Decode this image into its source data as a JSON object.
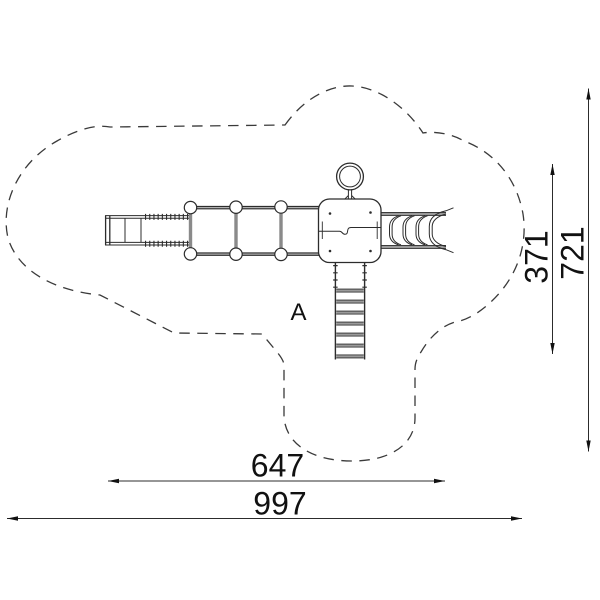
{
  "drawing": {
    "label_a": "A",
    "dimensions": {
      "inner_width": "647",
      "total_width": "997",
      "inner_height": "371",
      "total_height": "721"
    },
    "colors": {
      "line": "#2c2c2c",
      "rail_gray": "#999999",
      "background": "#ffffff"
    },
    "parts": [
      "safety-zone-outline",
      "climb-ramp",
      "rope-bridge",
      "tower-platform",
      "overhead-ring",
      "wave-slide",
      "access-ladder"
    ]
  }
}
